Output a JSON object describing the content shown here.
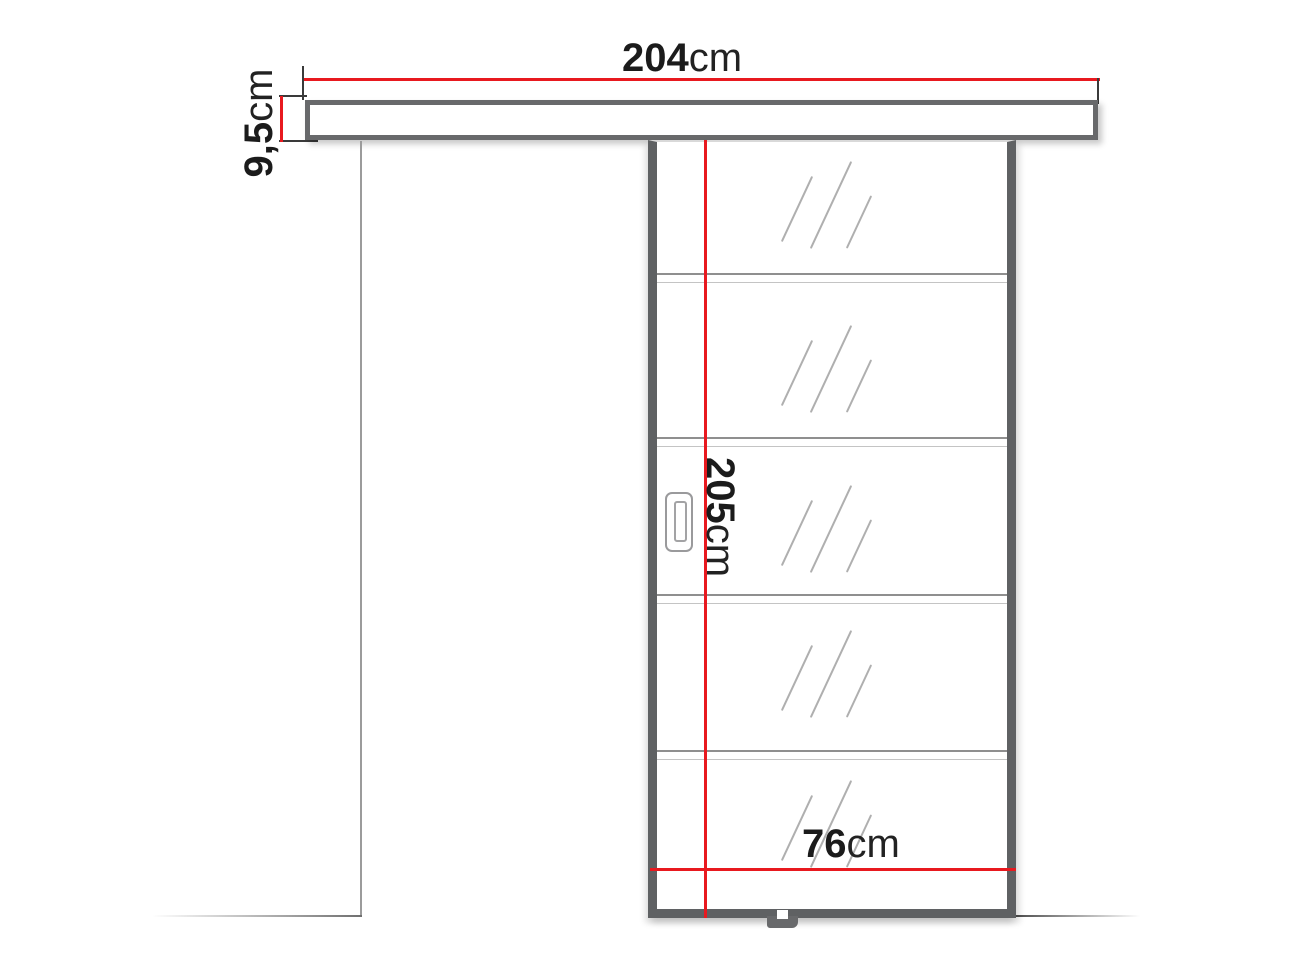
{
  "drawing": {
    "type": "sliding-door-technical-drawing",
    "dimensions": {
      "rail_width": {
        "value": "204",
        "unit": "cm"
      },
      "rail_height": {
        "value": "9,5",
        "unit": "cm"
      },
      "door_height": {
        "value": "205",
        "unit": "cm"
      },
      "door_width": {
        "value": "76",
        "unit": "cm"
      }
    },
    "glass_panel_count": 5,
    "colors": {
      "dimension_line": "#e8191f",
      "frame": "#68696b",
      "sketch_line": "#9b9b9b",
      "label_text": "#1b1b1b"
    }
  }
}
